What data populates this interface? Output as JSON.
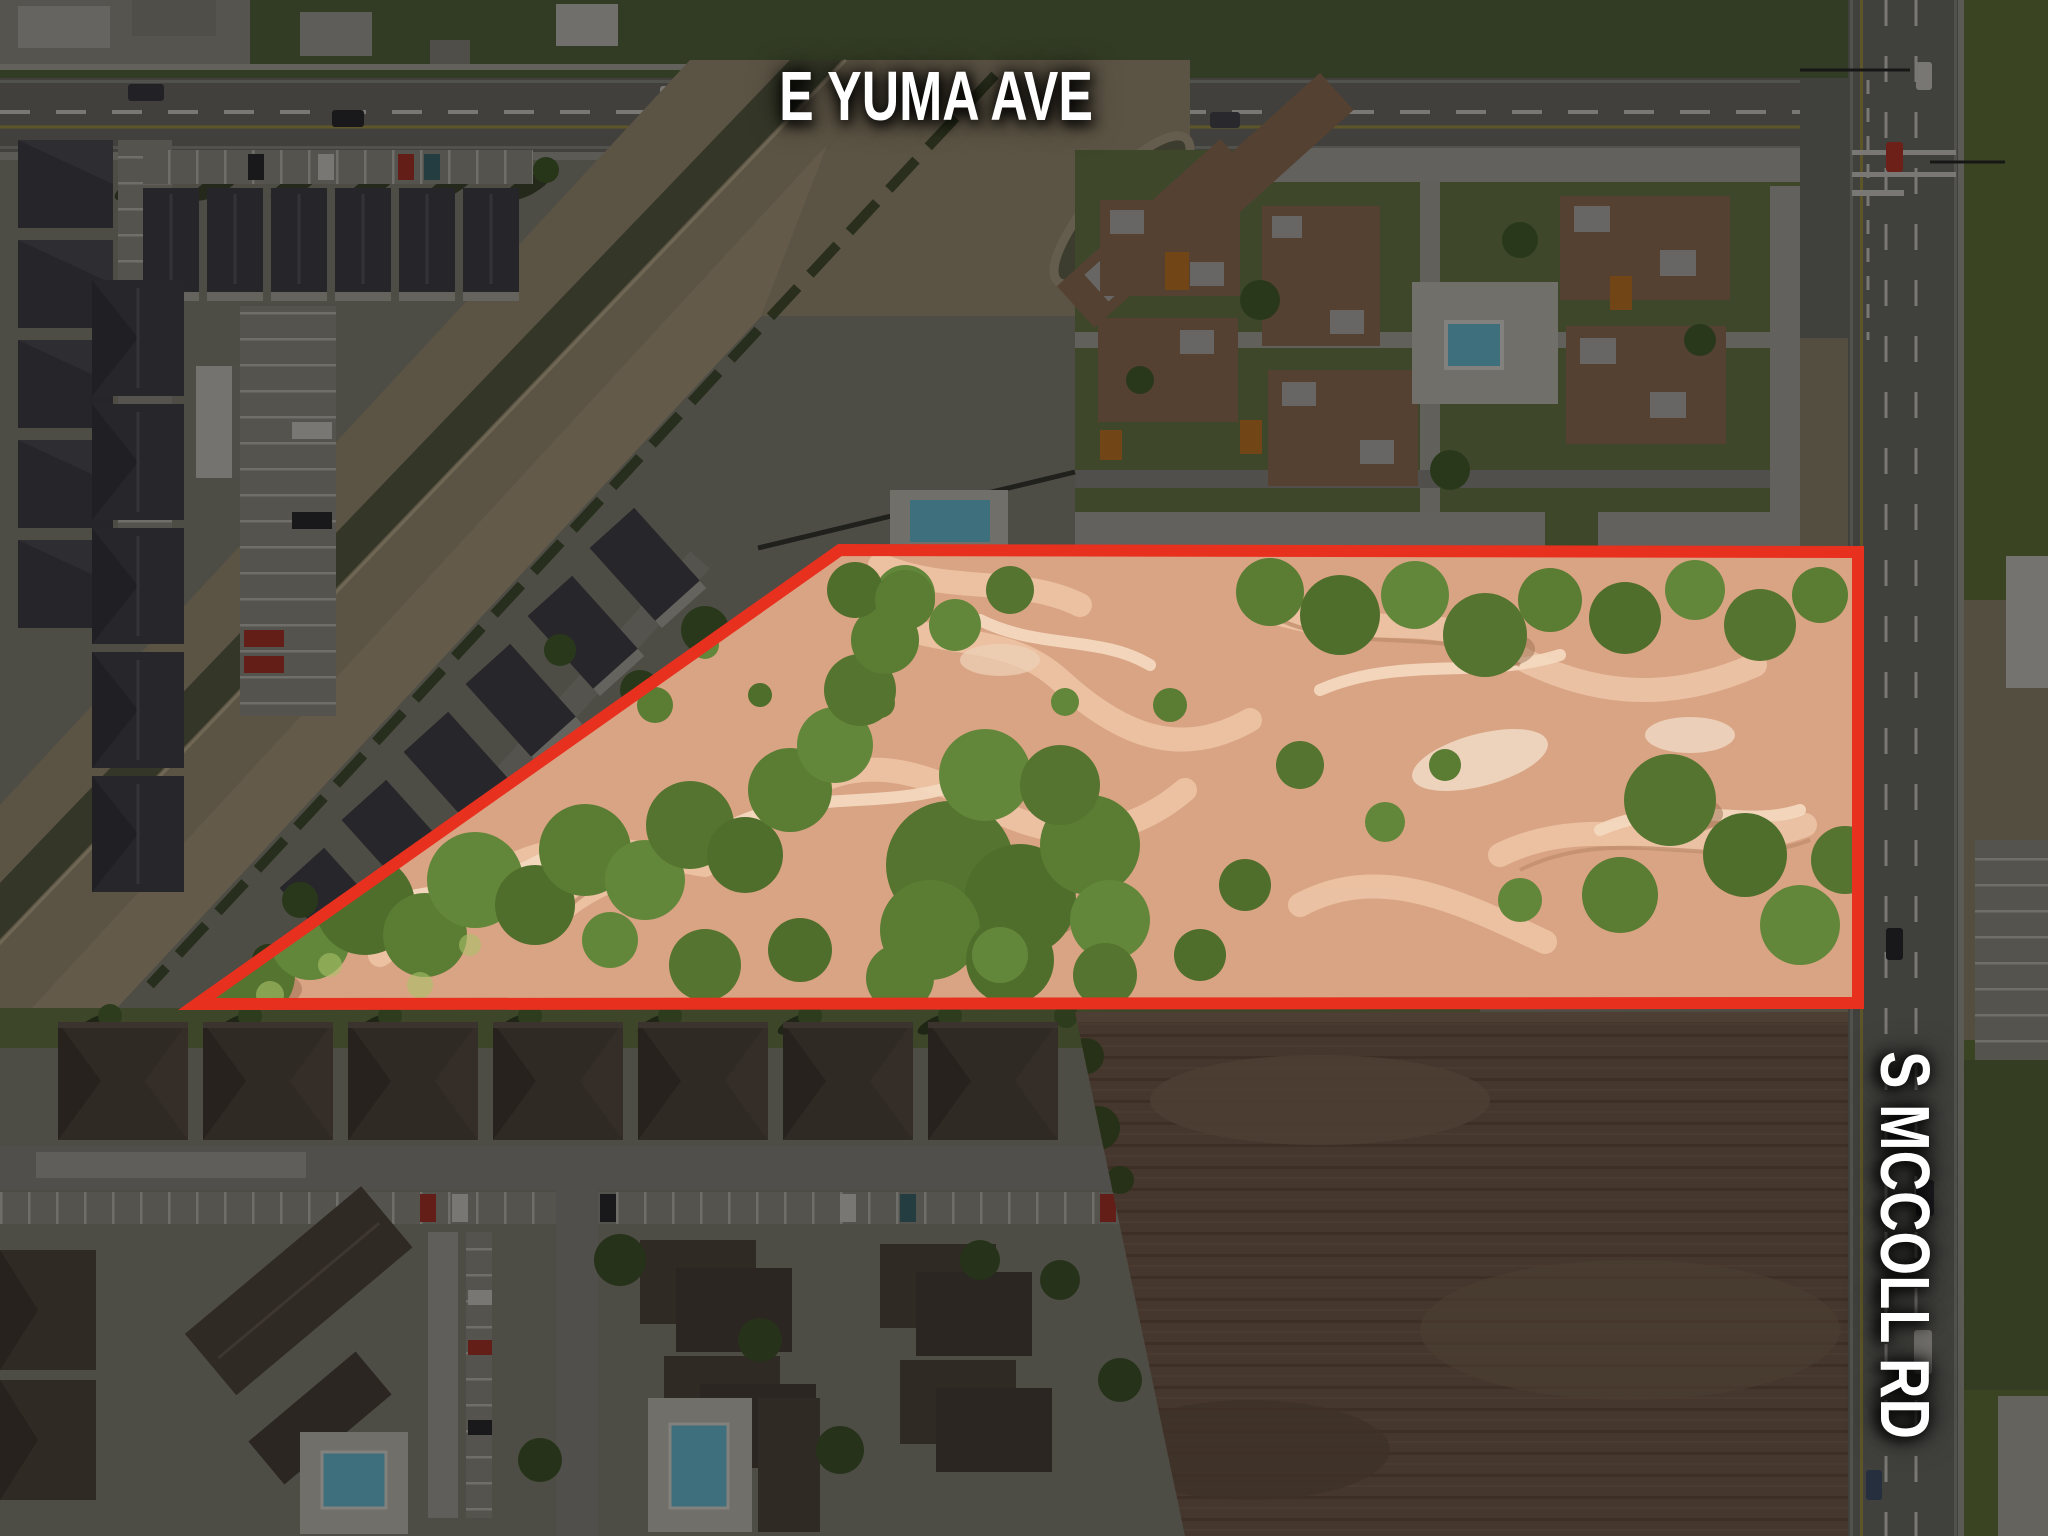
{
  "map": {
    "street_labels": {
      "top": {
        "text": "E YUMA AVE"
      },
      "right": {
        "text": "S MCCOLL RD"
      }
    },
    "property_boundary": {
      "outline_color": "#e8301f",
      "outline_width": 12,
      "polygon_points": "840,550 1858,552 1858,1003 197,1004",
      "shade_path": "M0,0 H2048 V1536 H0 Z M840,550 L1858,552 L1858,1003 L197,1004 Z",
      "shade_opacity": 0.44
    }
  }
}
